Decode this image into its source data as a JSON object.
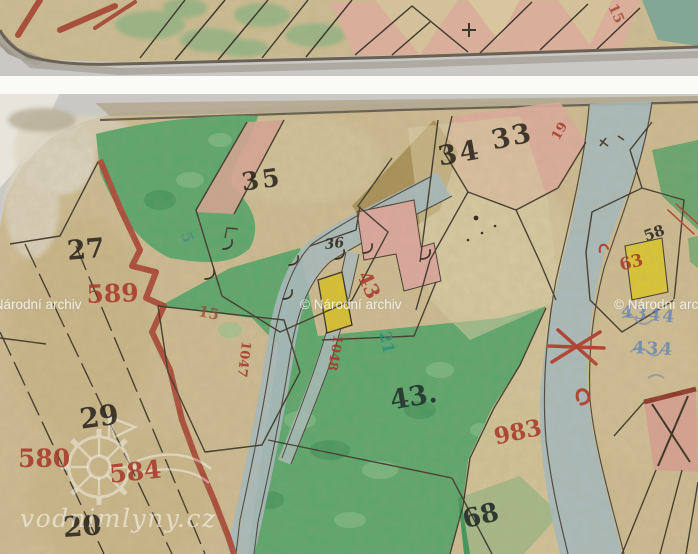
{
  "window": {
    "width": 698,
    "height": 554,
    "kind": "archival cadastral map scan"
  },
  "watermarks": {
    "archive_notice": "© Národní archiv",
    "site": "vodnimlyny.cz"
  },
  "colors": {
    "background": "#c9c8c4",
    "paper": "#cfbd93",
    "green_paint": "#58a76c",
    "stream_blue": "#a7bcc2",
    "road_red": "#ab4737",
    "ink_black": "#2b251c",
    "number_red": "#a8392b",
    "building_yellow": "#d9c22e",
    "building_pink": "#dfa8a0",
    "teal_number": "#2f8f7e",
    "blue_pencil": "#6484b4"
  },
  "top_sheet": {
    "parcel_number_red_15": "15"
  },
  "main_sheet": {
    "parcel_numbers_black": {
      "n27": "27",
      "n35": "35",
      "n34": "34",
      "n33": "33",
      "n29": "29",
      "n20": "20",
      "n43": "43.",
      "n68": "68",
      "n58": "58",
      "n36": "36"
    },
    "parcel_numbers_red": {
      "n589": "589",
      "n580": "580",
      "n584": "584",
      "n983": "983",
      "n43": "43",
      "n63": "63",
      "n19": "19",
      "n1047": "1047",
      "n1048": "1048",
      "n15": "15"
    },
    "other_marks": {
      "teal_21": "21",
      "blue_pencil_4344": "4344",
      "blue_pencil_434": "434",
      "blue_pencil_5": "5"
    }
  }
}
